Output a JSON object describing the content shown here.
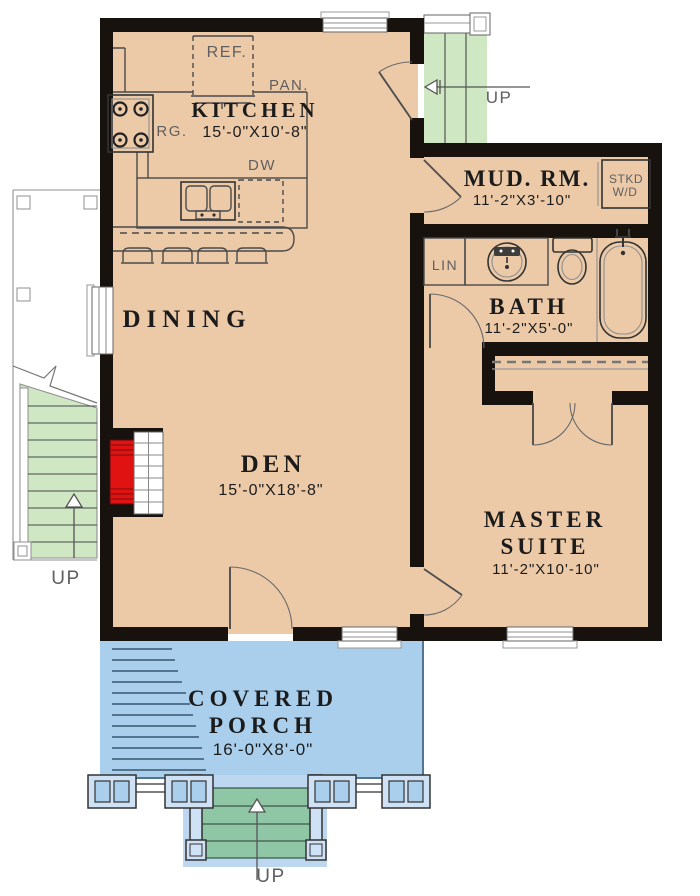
{
  "plan": {
    "type": "floor-plan",
    "rooms": {
      "kitchen": {
        "name": "KITCHEN",
        "dims": "15'-0\"X10'-8\""
      },
      "dining": {
        "name": "DINING"
      },
      "den": {
        "name": "DEN",
        "dims": "15'-0\"X18'-8\""
      },
      "mud_room": {
        "name": "MUD. RM.",
        "dims": "11'-2\"X3'-10\""
      },
      "bath": {
        "name": "BATH",
        "dims": "11'-2\"X5'-0\""
      },
      "master_suite": {
        "name_line1": "MASTER",
        "name_line2": "SUITE",
        "dims": "11'-2\"X10'-10\""
      },
      "covered_porch": {
        "name_line1": "COVERED",
        "name_line2": "PORCH",
        "dims": "16'-0\"X8'-0\""
      }
    },
    "fixtures": {
      "refrigerator": "REF.",
      "pantry": "PAN.",
      "range": "RG.",
      "dishwasher": "DW",
      "stacked_washer_dryer_line1": "STKD",
      "stacked_washer_dryer_line2": "W/D",
      "linen": "LIN"
    },
    "stairs": {
      "upper_stairs_label": "UP",
      "side_stairs_label": "UP",
      "porch_steps_label": "UP"
    },
    "colors": {
      "floor": "#eccaa8",
      "wall": "#17120d",
      "stair-green": "#cfe7c3",
      "porch-blue": "#aacfec",
      "step-green": "#8fc7a6",
      "column-blue": "#cfe2f5",
      "fire-red": "#e01212",
      "deck-line": "#55748f"
    }
  }
}
